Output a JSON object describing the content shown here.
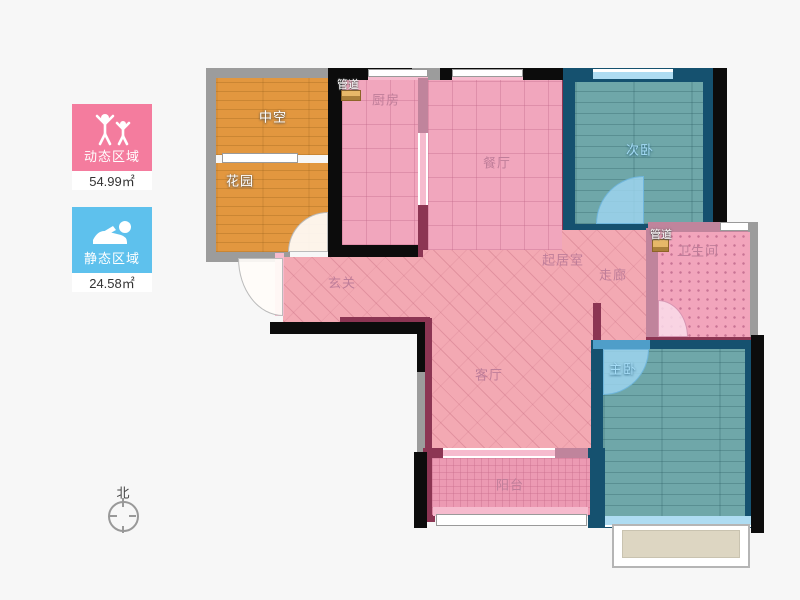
{
  "legend": {
    "dynamic": {
      "label": "动态区域",
      "value": "54.99㎡",
      "color": "#f47c9e",
      "icon": "people-active-icon"
    },
    "static": {
      "label": "静态区域",
      "value": "24.58㎡",
      "color": "#5ec1ed",
      "icon": "person-sleeping-icon"
    }
  },
  "compass": {
    "north": "北"
  },
  "rooms": {
    "void": "中空",
    "garden": "花园",
    "duct_top": "管道",
    "kitchen": "厨房",
    "dining": "餐厅",
    "bedroom2": "次卧",
    "duct_bath": "管道",
    "bathroom": "卫生间",
    "living": "起居室",
    "corridor": "走廊",
    "foyer": "玄关",
    "parlor": "客厅",
    "master": "主卧",
    "balcony": "阳台"
  },
  "colors": {
    "legend_dynamic": "#f47c9e",
    "legend_static": "#5ec1ed",
    "wall_dark": "#0c0c0c",
    "wall_gray": "#9c9c9c",
    "wall_maroon": "#8c3553",
    "wall_blue": "#15516f",
    "floor_pink": "#f1a6bd",
    "floor_teal": "#6fa7a9",
    "floor_orange": "#e2973f",
    "bay_window_fill": "#ddd6c2"
  }
}
